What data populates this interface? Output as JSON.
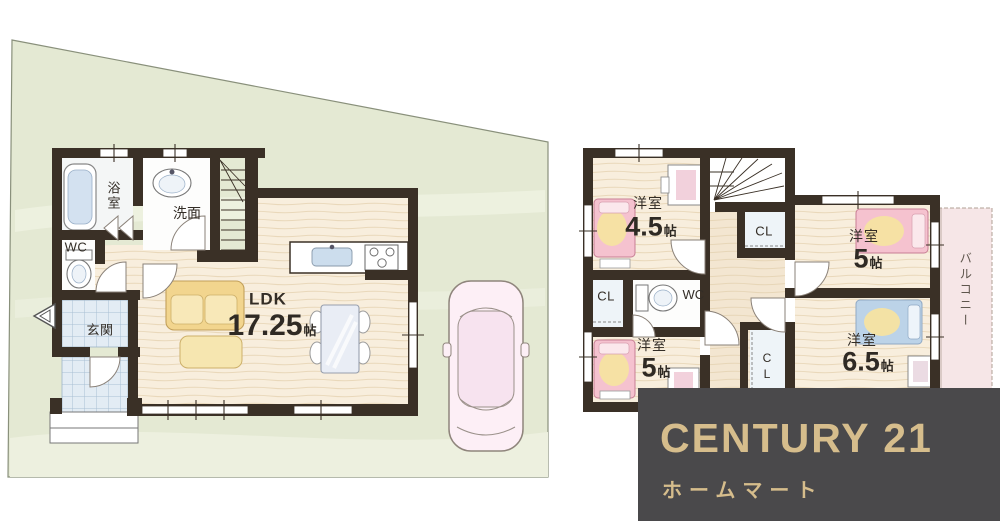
{
  "floor1": {
    "bath": "浴室",
    "washroom": "洗面",
    "wc": "WC",
    "entrance": "玄関",
    "ldk": {
      "label": "LDK",
      "size": "17.25",
      "unit": "帖"
    }
  },
  "floor2": {
    "bedroom_small": {
      "label": "洋室",
      "size": "4.5",
      "unit": "帖"
    },
    "bedroom_right": {
      "label": "洋室",
      "size": "5",
      "unit": "帖"
    },
    "bedroom_left": {
      "label": "洋室",
      "size": "5",
      "unit": "帖"
    },
    "bedroom_large": {
      "label": "洋室",
      "size": "6.5",
      "unit": "帖"
    },
    "closet_top": "CL",
    "closet_mid": "CL",
    "closet_bottom": "CL",
    "wc": "WC",
    "balcony": "バルコニー"
  },
  "logo": {
    "brand": "CENTURY 21",
    "company": "ホームマート"
  },
  "colors": {
    "wall": "#3a3026",
    "site_green": "#e4e9d3",
    "floor_wood": "#f8eedd",
    "tile_blue": "#e3ecf4",
    "bed_pink": "#f5c2cf",
    "bed_blue": "#bcd3e8",
    "blanket_yellow": "#f5e3a1",
    "banner_bg": "#4a494b",
    "banner_gold": "#d6bd8c"
  }
}
